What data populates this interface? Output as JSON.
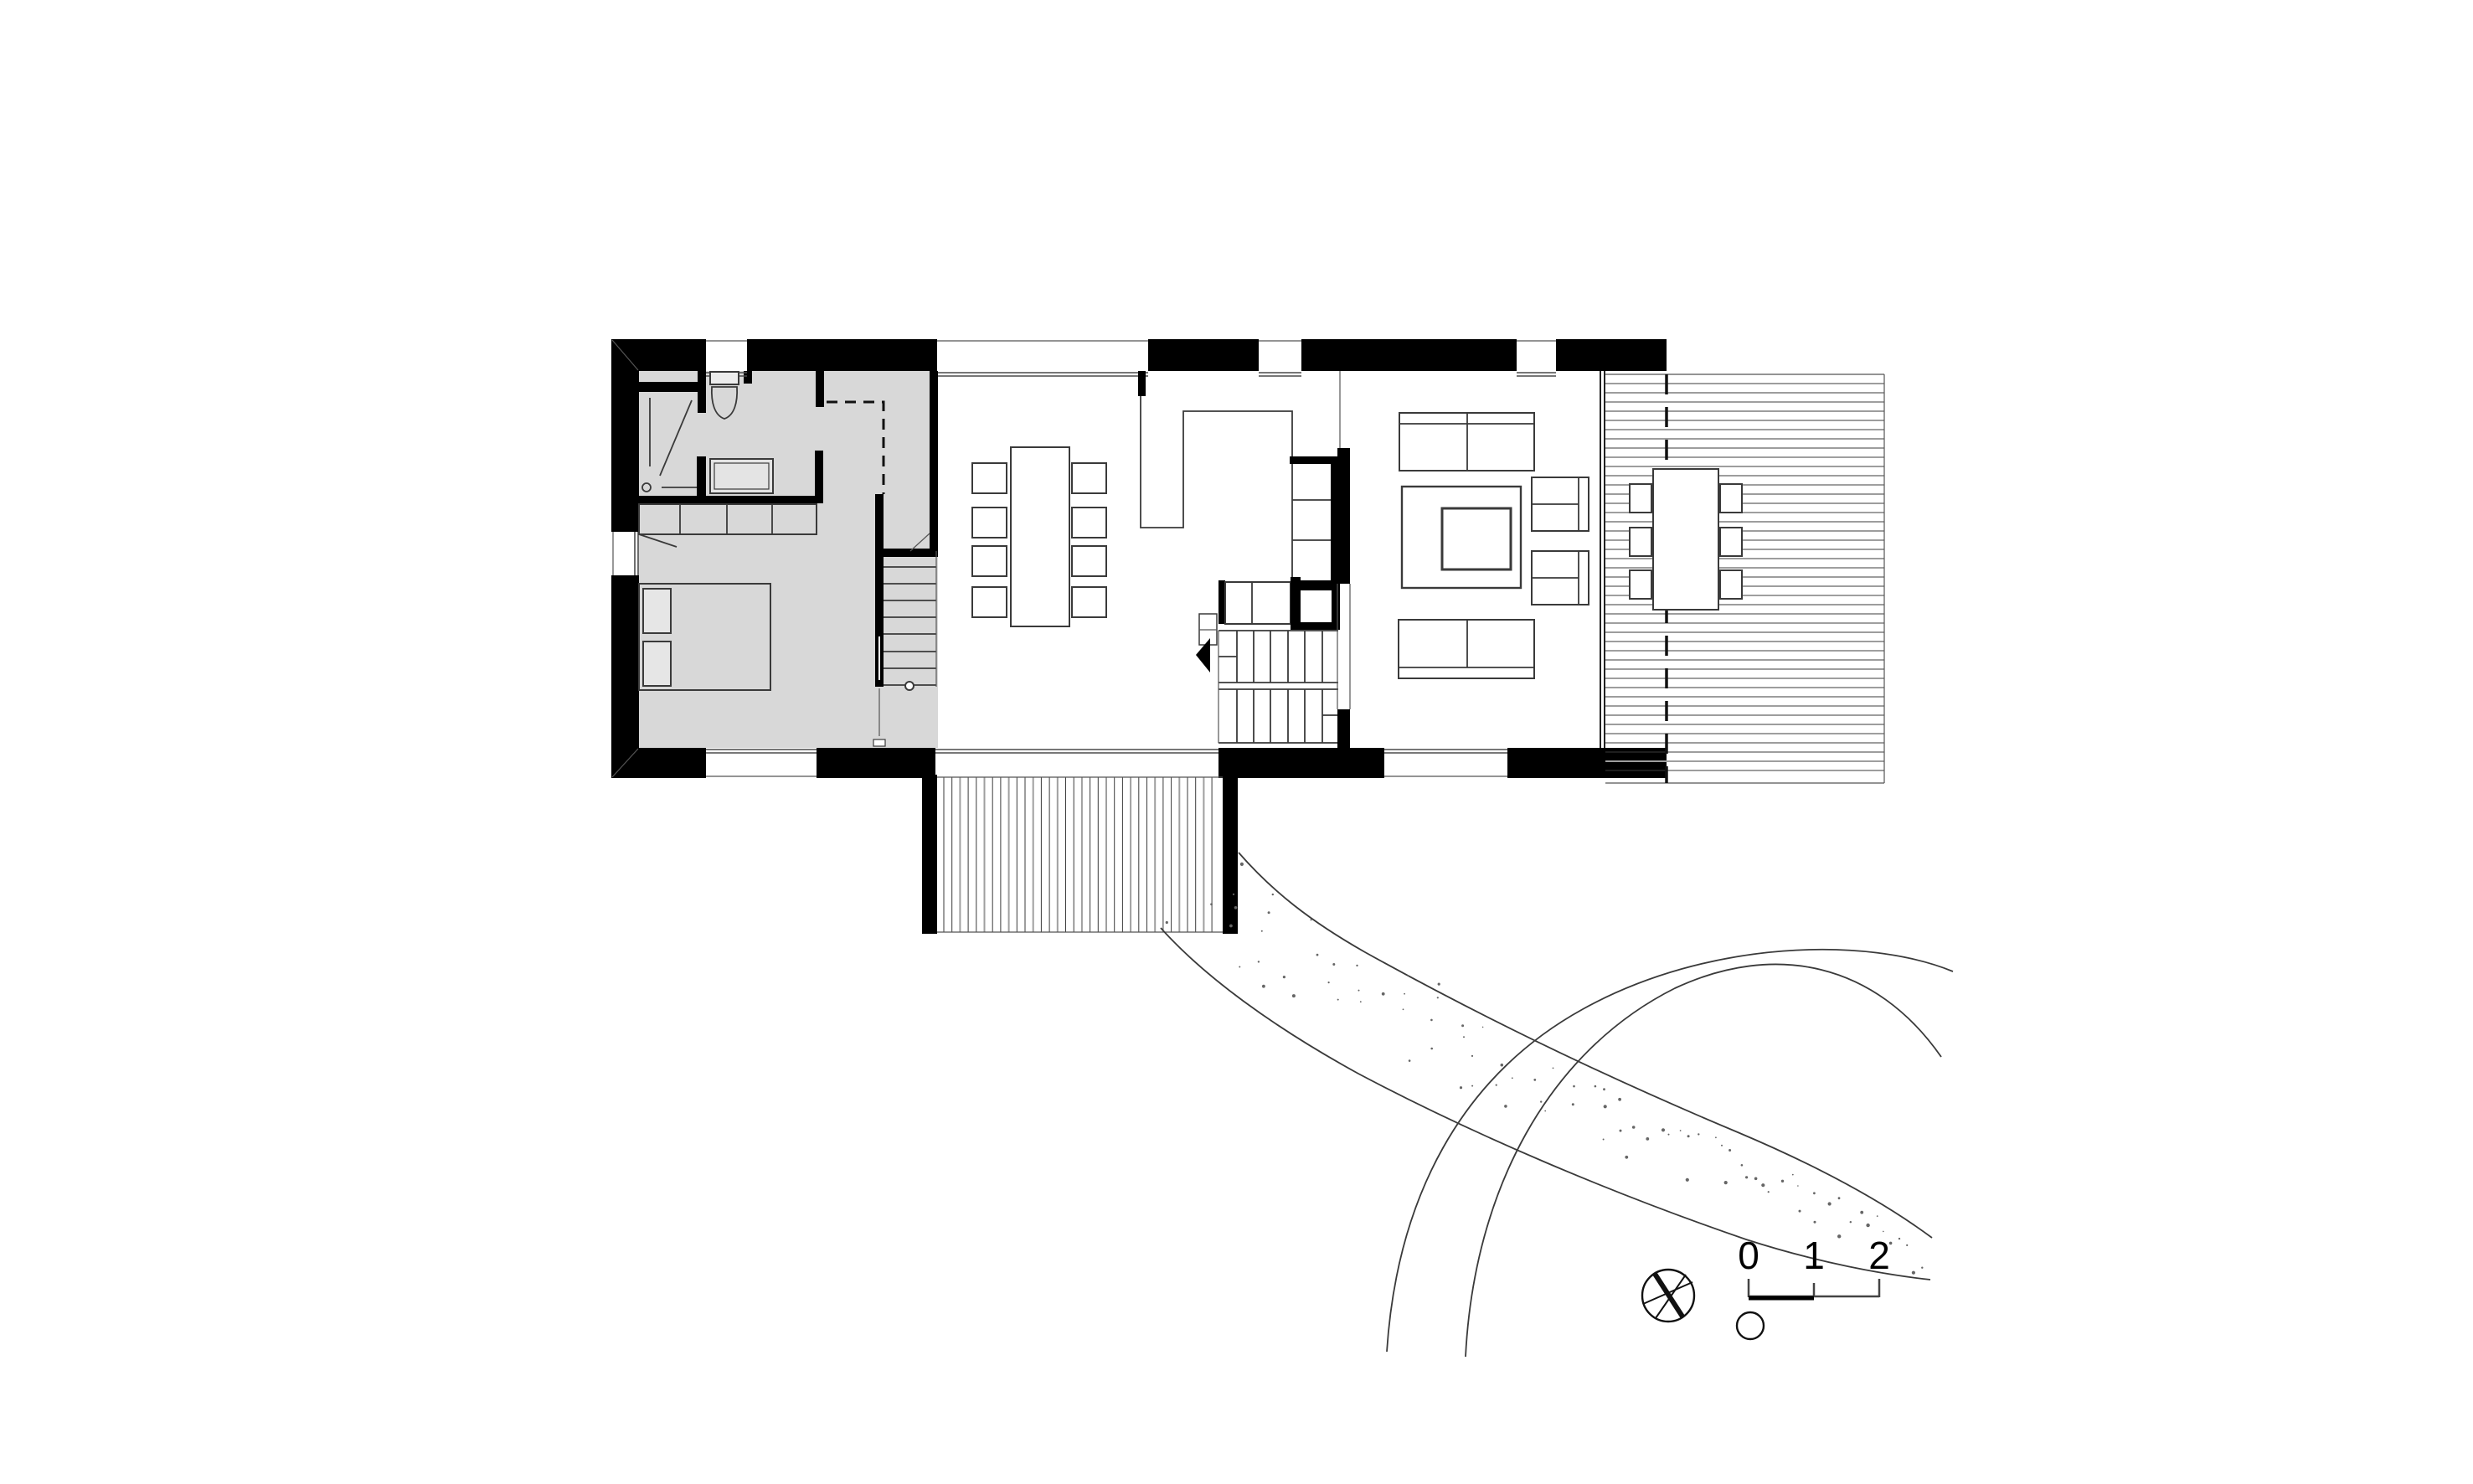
{
  "scale_bar": {
    "labels": [
      "0",
      "1",
      "2"
    ]
  },
  "colors": {
    "background": "#ffffff",
    "wall": "#000000",
    "secondary_floor": "#d8d8d8",
    "furniture_stroke": "#3a3a3a",
    "thin_line": "#555555",
    "plank_dark": "#3b3b3b",
    "plank_light": "#9f9f9f",
    "path_line": "#1f1f1f"
  }
}
